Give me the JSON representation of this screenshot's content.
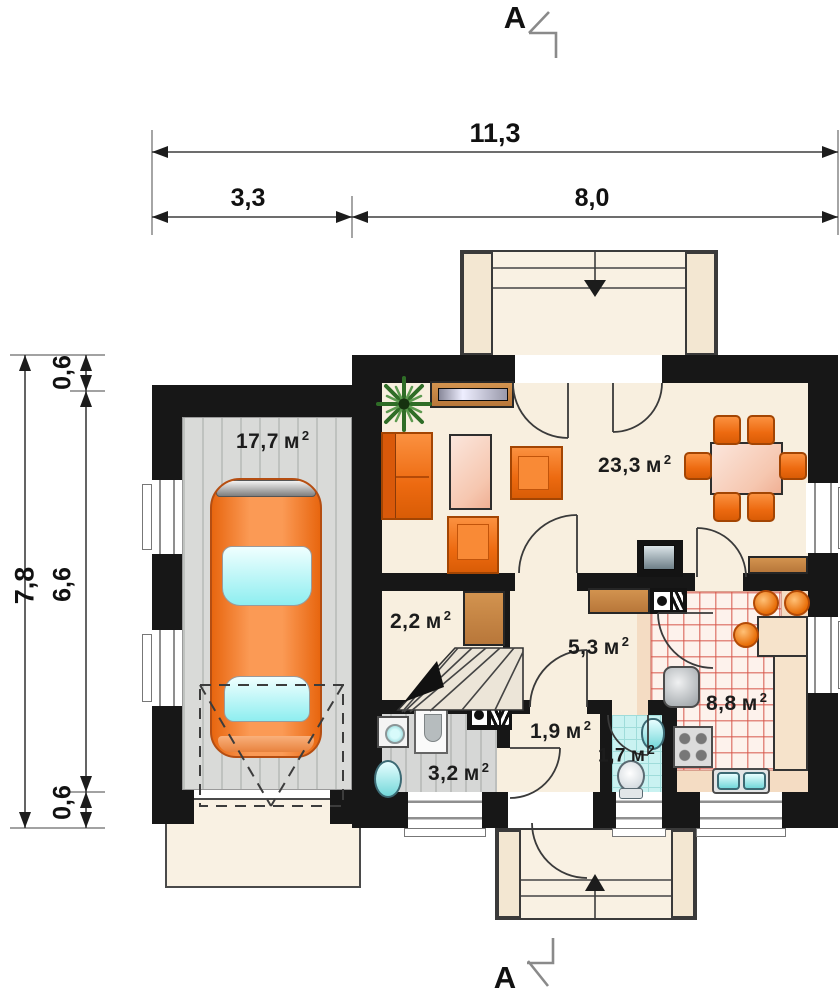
{
  "section_markers": {
    "top": "A",
    "bottom": "A"
  },
  "dimensions": {
    "horizontal_total": "11,3",
    "horizontal_segments": [
      "3,3",
      "8,0"
    ],
    "vertical_total": "7,8",
    "vertical_segments": [
      "0,6",
      "6,6",
      "0,6"
    ]
  },
  "units": {
    "area_symbol": "м",
    "area_sup": "2"
  },
  "rooms": [
    {
      "id": "garage",
      "area": "17,7"
    },
    {
      "id": "living-dining",
      "area": "23,3"
    },
    {
      "id": "storage",
      "area": "2,2"
    },
    {
      "id": "hall",
      "area": "5,3"
    },
    {
      "id": "vestibule",
      "area": "1,9"
    },
    {
      "id": "bathroom",
      "area": "3,2"
    },
    {
      "id": "wc",
      "area": "1,7"
    },
    {
      "id": "kitchen",
      "area": "8,8"
    }
  ],
  "colors": {
    "wall": "#171717",
    "floor_main": "#f8efdf",
    "floor_garage": "#d9dad8",
    "floor_kitchen_grid": "#d65448",
    "floor_wc": "#c9f2f1",
    "furniture_orange": "#ed6a10",
    "table_pink": "#f6c7b0",
    "counter_brown": "#c9854d",
    "water_cyan": "#74d8da",
    "car_orange": "#fb9a55"
  }
}
